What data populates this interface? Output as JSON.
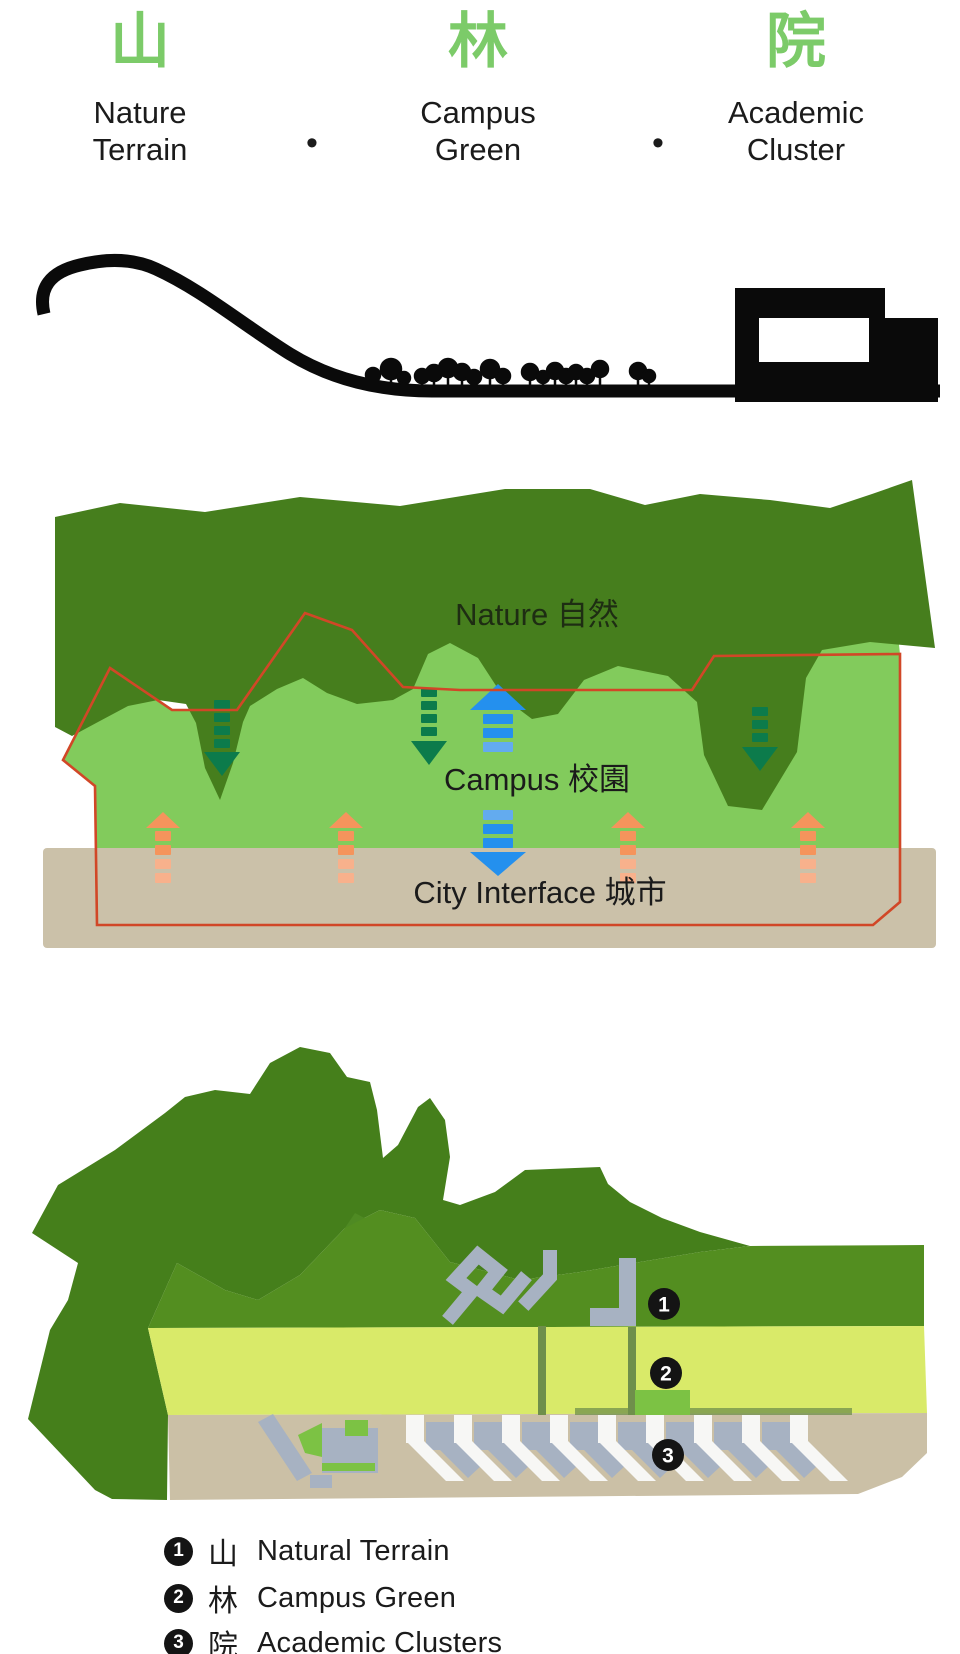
{
  "header": {
    "separator": "•",
    "items": [
      {
        "char": "山",
        "line1": "Nature",
        "line2": "Terrain"
      },
      {
        "char": "林",
        "line1": "Campus",
        "line2": "Green"
      },
      {
        "char": "院",
        "line1": "Academic",
        "line2": "Cluster"
      }
    ]
  },
  "zone_diagram": {
    "nature_label": "Nature  自然",
    "campus_label": "Campus  校園",
    "city_label": "City Interface  城市"
  },
  "site_plan": {
    "markers": [
      "1",
      "2",
      "3"
    ]
  },
  "legend": {
    "rows": [
      {
        "num": "1",
        "char": "山",
        "label": "Natural Terrain"
      },
      {
        "num": "2",
        "char": "林",
        "label": "Campus Green"
      },
      {
        "num": "3",
        "char": "院",
        "label": "Academic Clusters"
      }
    ]
  },
  "colors": {
    "header_green": "#7CCB69",
    "ink": "#1B1B1B",
    "black": "#0A0A0A",
    "nature_green": "#467E1D",
    "nature_label": "#1E2D13",
    "campus_green": "#82CB5C",
    "tan": "#CBC1A9",
    "red": "#D14727",
    "arrow_green": "#0C7B4B",
    "arrow_blue": "#2490EE",
    "arrow_blue_light": "#63ABEF",
    "arrow_orange": "#F5945C",
    "arrow_orange_light": "#F8B18C",
    "mountain_green": "#457F1B",
    "mountain_green_light": "#4F8A23",
    "mid_green": "#538E20",
    "band_yellow": "#D9EA69",
    "tan2": "#CBC0A6",
    "path_olive": "#6F8F4B",
    "accent_green": "#7CC244",
    "building_gray": "#A7B2C2",
    "ramp_white": "#F7F7F5",
    "badge_black": "#141414"
  }
}
